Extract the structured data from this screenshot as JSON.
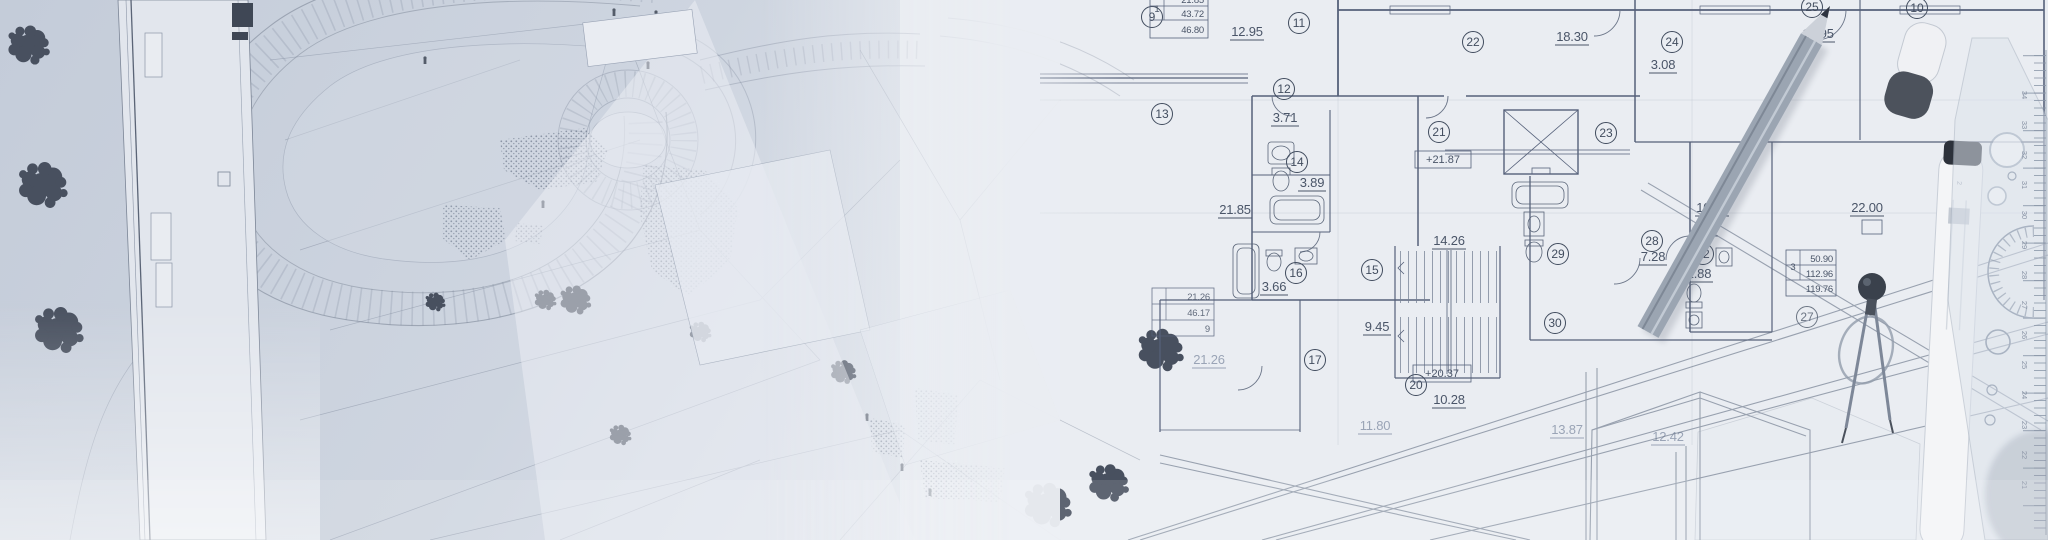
{
  "palette": {
    "paper": "#eaedf2",
    "site_background": "#c6cedb",
    "line_dark": "#4c576b",
    "line_faint": "#97a1b3",
    "tree": "#48505f",
    "pencil_body": "#9da7b4",
    "tool_dark": "#454b56"
  },
  "floor_plan": {
    "room_numbers": [
      "9",
      "11",
      "22",
      "24",
      "25",
      "10",
      "12",
      "13",
      "14",
      "21",
      "23",
      "16",
      "15",
      "29",
      "28",
      "30",
      "32",
      "27",
      "20",
      "17"
    ],
    "area_values": [
      "12.95",
      "18.30",
      "3.08",
      "12.95",
      "3.71",
      "3.89",
      "21.85",
      "14.26",
      "3.66",
      "10.18",
      "22.00",
      "7.28",
      "2.88",
      "9.45",
      "10.28",
      "11.80",
      "13.87",
      "12.42",
      "21.26"
    ],
    "elevation_marks": [
      "+21.87",
      "+20.37"
    ],
    "unit_tables": [
      {
        "unit": "1",
        "rows": [
          "21.85",
          "43.72",
          "46.80"
        ]
      },
      {
        "unit": "",
        "rows": [
          "21.26",
          "46.17",
          "9"
        ]
      },
      {
        "unit": "3",
        "rows": [
          "50.90",
          "112.96",
          "119.76"
        ]
      }
    ]
  },
  "tools": {
    "ruler_numbers": [
      "34",
      "33",
      "32",
      "31",
      "30",
      "29",
      "28",
      "27",
      "26",
      "25",
      "24",
      "23",
      "22",
      "21"
    ],
    "tube_label": "2"
  }
}
